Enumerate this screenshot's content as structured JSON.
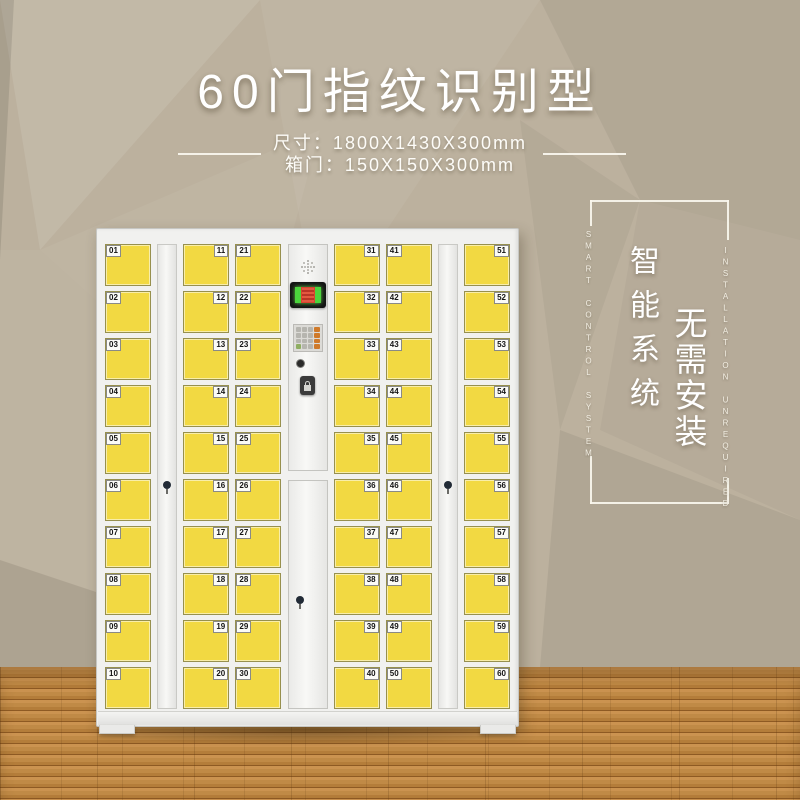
{
  "header": {
    "title": "60门指纹识别型",
    "spec_dimensions": "尺寸：1800X1430X300mm",
    "spec_door": "箱门：150X150X300mm"
  },
  "side_panel": {
    "en_left": "SMART CONTROL SYSTEM",
    "cn_primary": "智能系统",
    "cn_secondary": "无需安装",
    "en_right": "INSTALLATION UNREQUIRED"
  },
  "locker": {
    "door_count": 60,
    "door_columns": [
      {
        "label_side": "left",
        "doors": [
          "01",
          "02",
          "03",
          "04",
          "05",
          "06",
          "07",
          "08",
          "09",
          "10"
        ]
      },
      {
        "label_side": "right",
        "doors": [
          "11",
          "12",
          "13",
          "14",
          "15",
          "16",
          "17",
          "18",
          "19",
          "20"
        ]
      },
      {
        "label_side": "left",
        "doors": [
          "21",
          "22",
          "23",
          "24",
          "25",
          "26",
          "27",
          "28",
          "29",
          "30"
        ]
      },
      {
        "label_side": "right",
        "doors": [
          "31",
          "32",
          "33",
          "34",
          "35",
          "36",
          "37",
          "38",
          "39",
          "40"
        ]
      },
      {
        "label_side": "left",
        "doors": [
          "41",
          "42",
          "43",
          "44",
          "45",
          "46",
          "47",
          "48",
          "49",
          "50"
        ]
      },
      {
        "label_side": "right",
        "doors": [
          "51",
          "52",
          "53",
          "54",
          "55",
          "56",
          "57",
          "58",
          "59",
          "60"
        ]
      }
    ],
    "control_panel_icons": [
      "speaker-icon",
      "fingerprint-screen",
      "keypad",
      "camera-dot-icon",
      "lock-handle-icon"
    ],
    "keypad_grid": {
      "rows": 4,
      "cols": 4
    }
  },
  "colors": {
    "wall_taupe": "#bcb19e",
    "floor_wood": "#c08a46",
    "cabinet_white": "#f1f1ef",
    "door_yellow": "#f2d942",
    "text_white": "#ffffff",
    "screen_green": "#4bd43c",
    "screen_red": "#d8422f",
    "keypad_orange": "#cf7a2a"
  }
}
